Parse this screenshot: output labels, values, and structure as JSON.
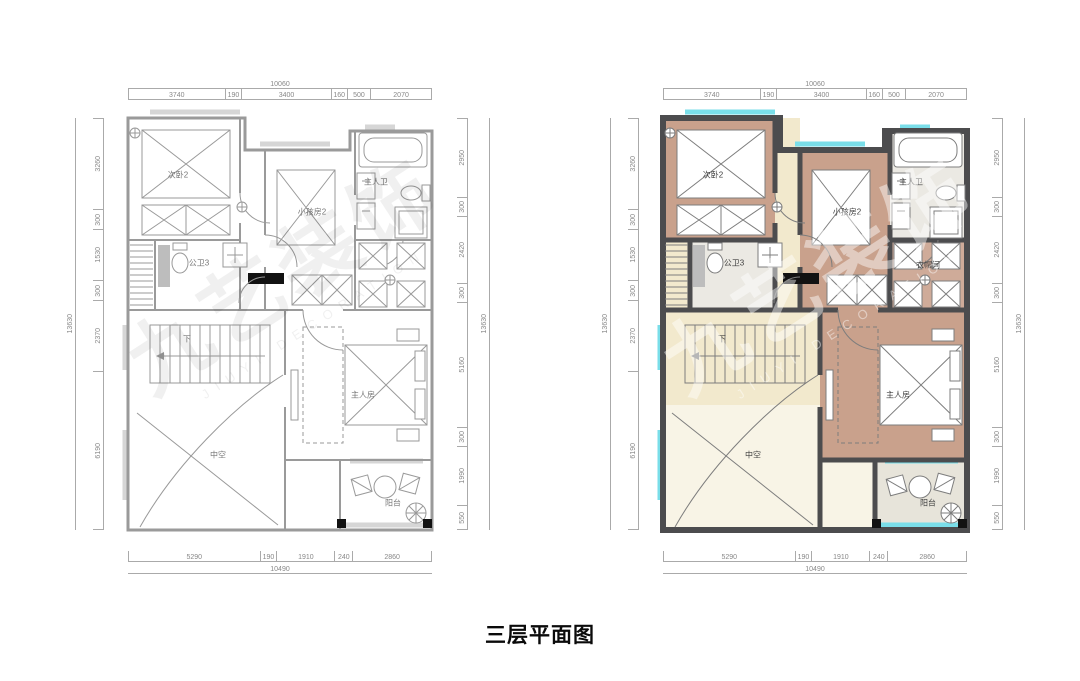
{
  "caption": "三层平面图",
  "watermark": {
    "cn": "九艺装饰",
    "en": "JIUYI DECORATION"
  },
  "rooms": {
    "bedroom2": "次卧2",
    "kids": "小孩房2",
    "master_bath": "主人卫",
    "bath3": "公卫3",
    "master": "主人房",
    "void": "中空",
    "balcony": "阳台",
    "cloak": "衣帽间",
    "stairs_down": "下"
  },
  "dims": {
    "top_total": "10060",
    "top_chain": [
      "3740",
      "190",
      "3400",
      "160",
      "500",
      "2070"
    ],
    "bottom_chain": [
      "5290",
      "190",
      "1910",
      "240",
      "2860"
    ],
    "bottom_total": "10490",
    "left_chain": [
      "3260",
      "300",
      "1530",
      "300",
      "2370",
      "6190"
    ],
    "left_total": "13630",
    "right_chain": [
      "2950",
      "300",
      "2420",
      "300",
      "5160",
      "300",
      "1990",
      "550"
    ],
    "right_total": "13630"
  },
  "colors": {
    "wall_dark": "#4c4c4e",
    "wall_light": "#9a9a9a",
    "bedroom_fill": "#c9a18c",
    "cloak_fill": "#cfab99",
    "bath_fill": "#ebe9e3",
    "hall_fill": "#f2e9cd",
    "void_fill": "#f8f4e6",
    "balcony_fill": "#e7e4da",
    "window_glass": "#7adee9"
  }
}
